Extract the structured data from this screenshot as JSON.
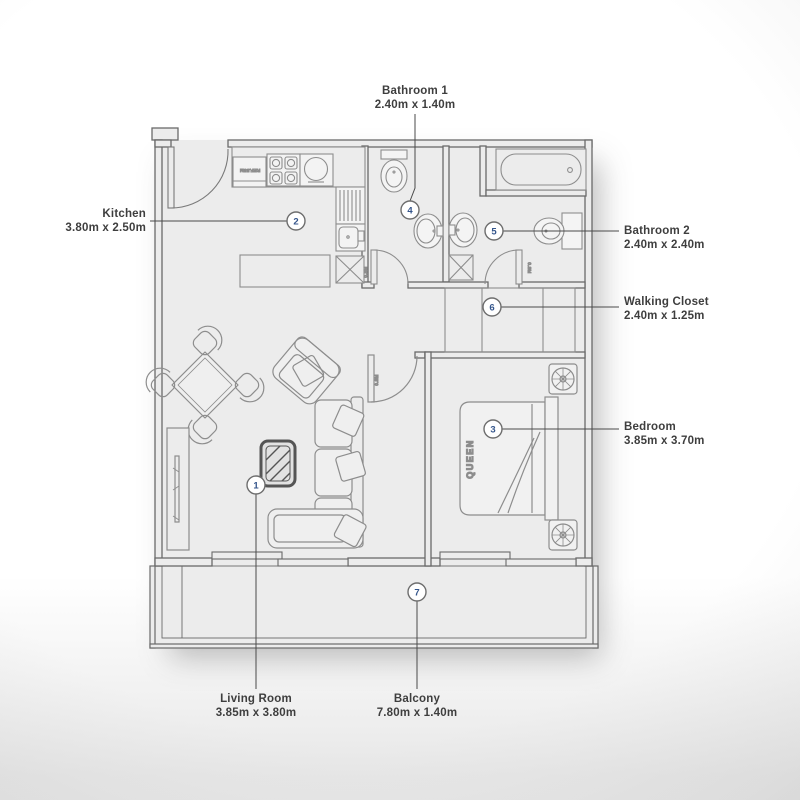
{
  "title": "Apartment Floor Plan",
  "palette": {
    "floor": "#ececec",
    "wall_line": "#6a6a6a",
    "furniture_line": "#8d8d8d",
    "label_text": "#3e3e3e",
    "callout_number": "#34558b",
    "callout_border": "#6e6e6e",
    "coffee_table_dark": "#555555"
  },
  "callouts": [
    {
      "number": "1",
      "name": "Living Room",
      "dims": "3.85m x 3.80m"
    },
    {
      "number": "2",
      "name": "Kitchen",
      "dims": "3.80m x 2.50m"
    },
    {
      "number": "3",
      "name": "Bedroom",
      "dims": "3.85m x 3.70m"
    },
    {
      "number": "4",
      "name": "Bathroom 1",
      "dims": "2.40m x 1.40m"
    },
    {
      "number": "5",
      "name": "Bathroom 2",
      "dims": "2.40m x 2.40m"
    },
    {
      "number": "6",
      "name": "Walking Closet",
      "dims": "2.40m x 1.25m"
    },
    {
      "number": "7",
      "name": "Balcony",
      "dims": "7.80m x 1.40m"
    }
  ],
  "furniture_text": {
    "bed": "QUEEN",
    "fridge": "REF.55M",
    "door_bathroom1": "0.8M",
    "door_bathroom2": "0.8M",
    "door_bedroom": "0.8M"
  }
}
